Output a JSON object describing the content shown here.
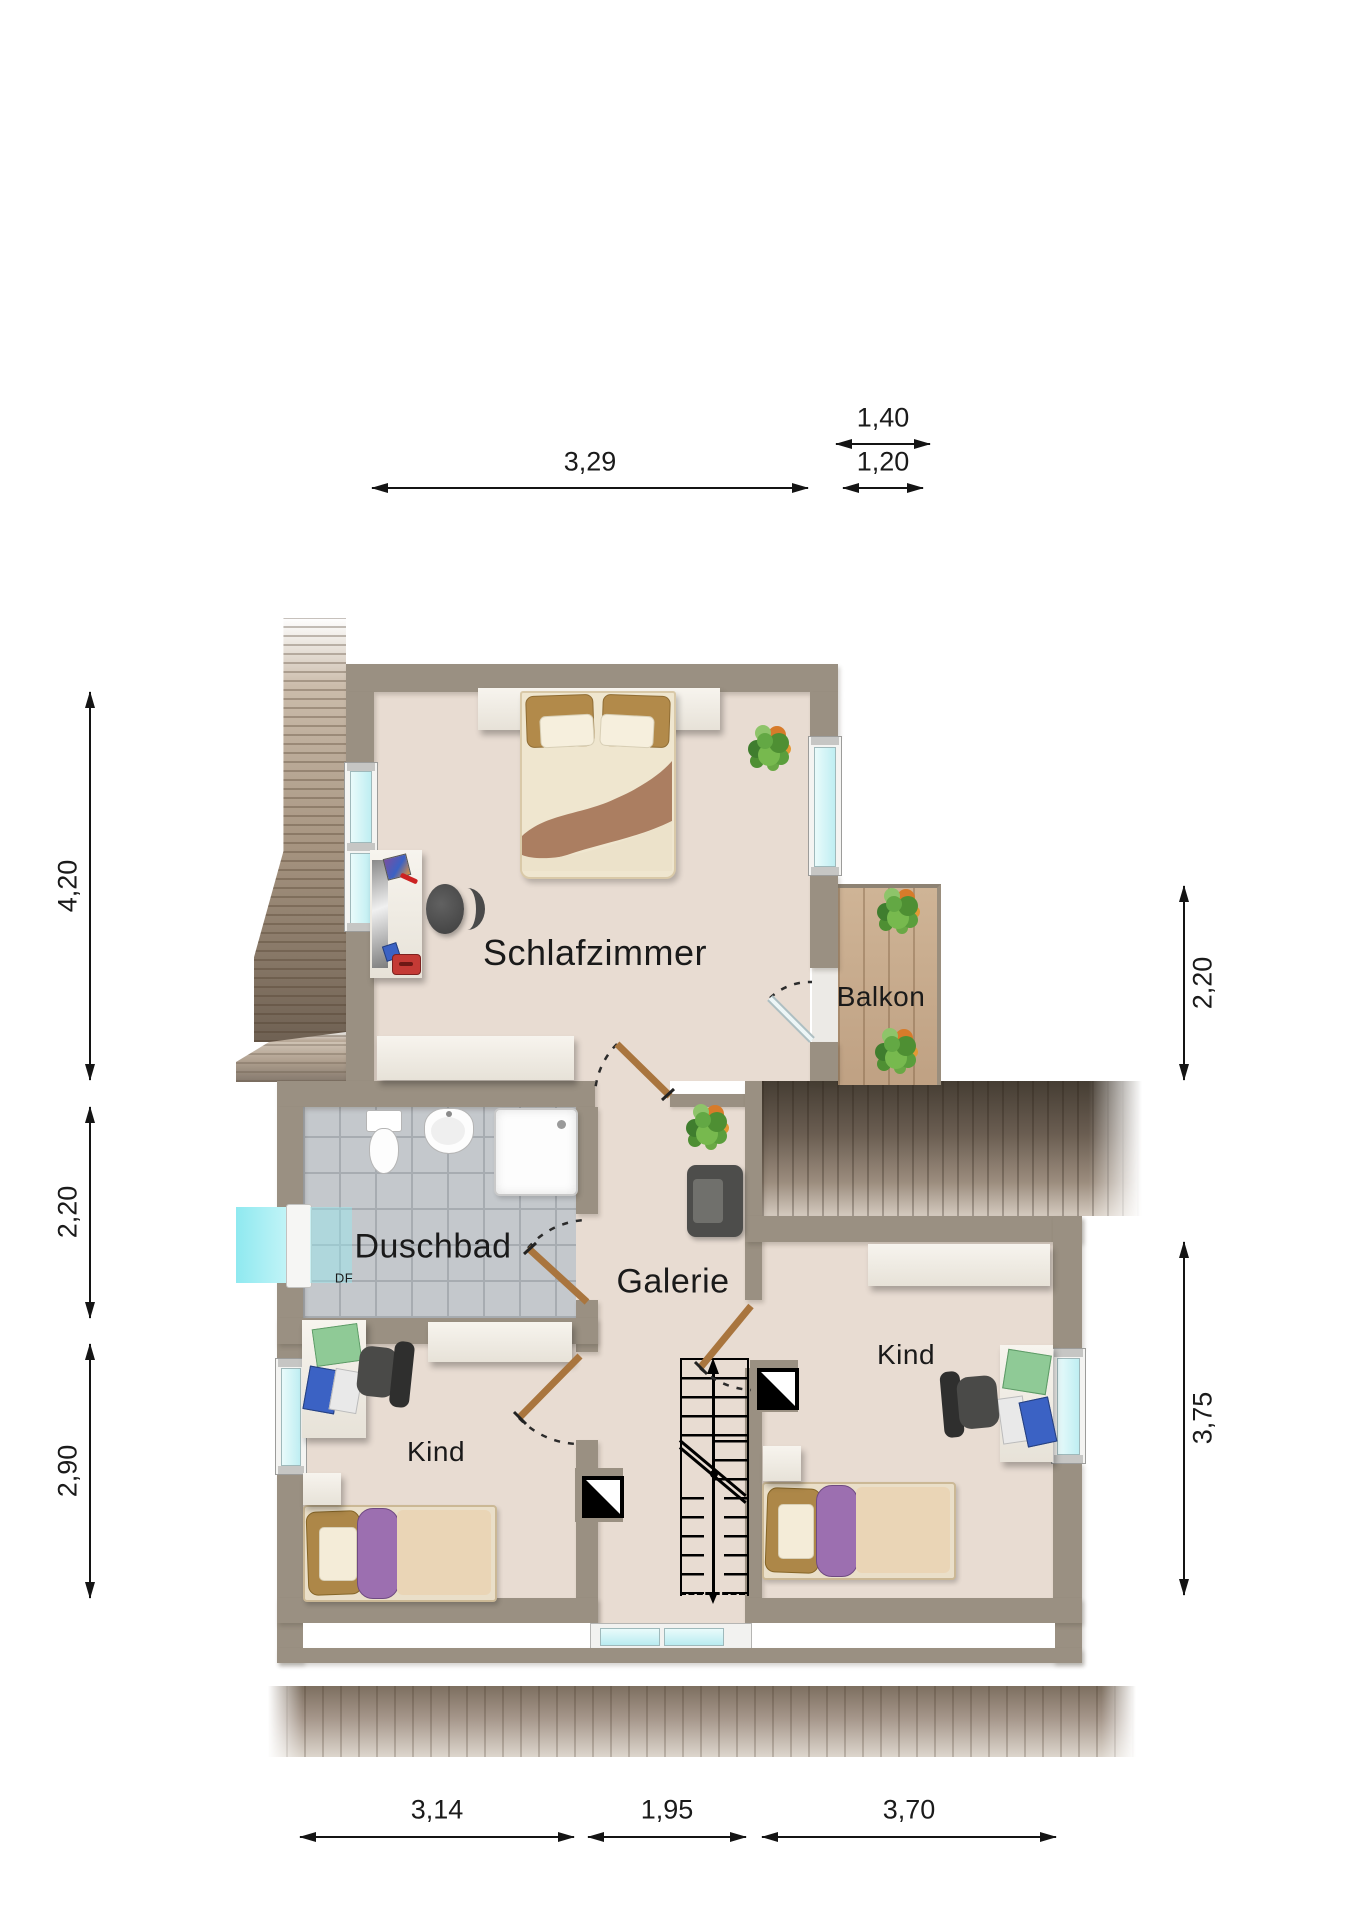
{
  "plan": {
    "rooms": {
      "schlafzimmer": {
        "label": "Schlafzimmer"
      },
      "balkon": {
        "label": "Balkon"
      },
      "duschbad": {
        "label": "Duschbad"
      },
      "galerie": {
        "label": "Galerie"
      },
      "kind_left": {
        "label": "Kind"
      },
      "kind_right": {
        "label": "Kind"
      }
    },
    "markers": {
      "roof_window_label": "DF"
    }
  },
  "dimensions": {
    "top": [
      {
        "value": "3,29"
      },
      {
        "value": "1,40"
      },
      {
        "value": "1,20"
      }
    ],
    "left": [
      {
        "value": "4,20"
      },
      {
        "value": "2,20"
      },
      {
        "value": "2,90"
      }
    ],
    "right": [
      {
        "value": "2,20"
      },
      {
        "value": "3,75"
      }
    ],
    "bottom": [
      {
        "value": "3,14"
      },
      {
        "value": "1,95"
      },
      {
        "value": "3,70"
      }
    ]
  },
  "colors": {
    "wall": "#9a9082",
    "floor": "#e8dcd2",
    "tile": "#c4c8cc",
    "balcony_wood": "#c9ad8f",
    "window_glass": "#cdeff3",
    "door_leaf": "#a9753e"
  }
}
